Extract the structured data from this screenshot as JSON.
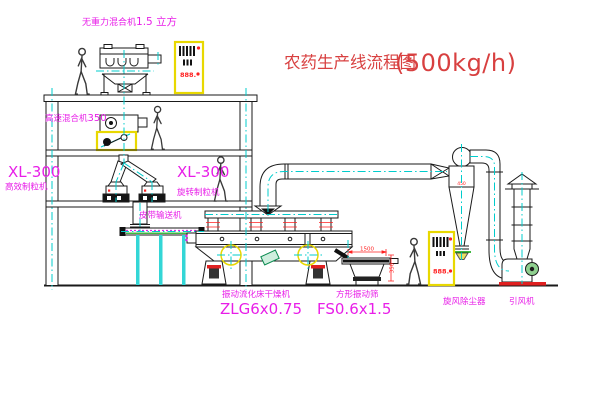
{
  "title": {
    "text": "农药生产线流程图",
    "capacity": "(500kg/h)"
  },
  "labels": {
    "gravity_mixer_name": "无重力混合机",
    "gravity_mixer_capacity": "1.5 立方",
    "high_speed_mixer_name": "高速混合机",
    "high_speed_mixer_capacity": "350",
    "granulator_left_model": "XL-300",
    "granulator_left_name": "高效制粒机",
    "granulator_right_model": "XL-300",
    "granulator_right_name": "旋转制粒机",
    "belt_conveyor": "皮带输送机",
    "dryer_name": "振动流化床干燥机",
    "dryer_model": "ZLG6x0.75",
    "sieve_name": "方形振动筛",
    "sieve_model": "FS0.6x1.5",
    "cyclone_name": "旋风除尘器",
    "fan_name": "引风机"
  },
  "dimensions": {
    "sieve_length": "1500",
    "sieve_height": "350",
    "cyclone_band": "450"
  },
  "cabinets": {
    "display_top": "888.",
    "display_right": "888."
  },
  "colors": {
    "line": "#1a1a1a",
    "centerline": "#00cccc",
    "label_magenta": "#e81ee8",
    "title_red": "#d84040",
    "dimension_red": "#ff2020",
    "cabinet_yellow": "#e8d800",
    "green": "#00a000"
  }
}
